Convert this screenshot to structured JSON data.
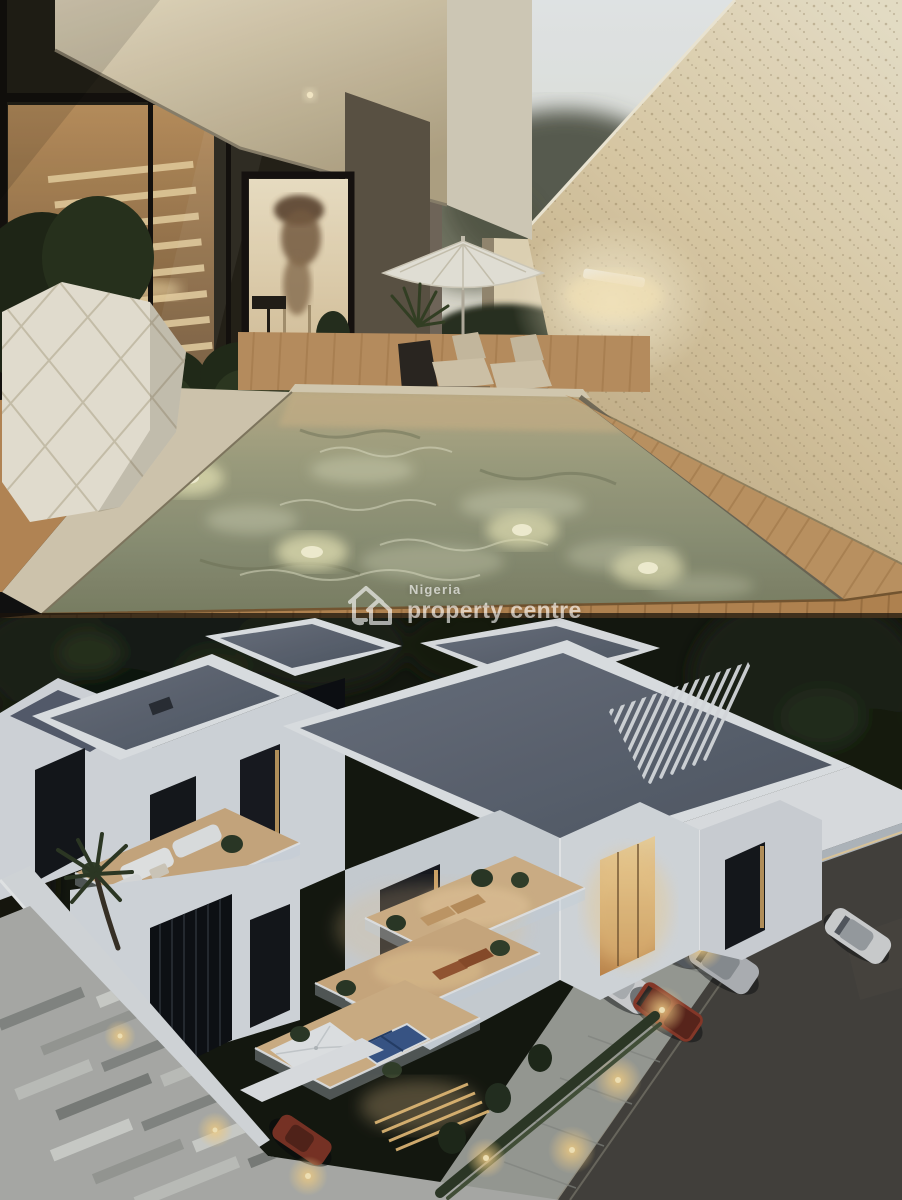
{
  "page": {
    "type": "property-listing-photo-collage",
    "photo_count": 2
  },
  "watermark": {
    "logo": "house-icon",
    "line1": "Nigeria",
    "line2": "property centre",
    "color": "#ffffff",
    "opacity": 0.62
  },
  "photos": [
    {
      "alt": "Dusk courtyard of a modern duplex: floor-to-ceiling glass with lit interior staircase, portrait wall art behind glass door, hanging plants and a white faceted planter, long lap pool with underwater lights, white patio umbrella with two sun loungers, tall speckled beige boundary wall with a glowing wall sconce, timber deck in the foreground",
      "key_elements": [
        "glass facade",
        "interior staircase",
        "portrait artwork",
        "patio umbrella",
        "sun loungers",
        "lap pool",
        "underwater lights",
        "boundary wall",
        "wall sconce",
        "hanging planters",
        "faceted vase planter",
        "timber deck"
      ]
    },
    {
      "alt": "Aerial dusk view of a white contemporary multi-storey residence: flat grey roofs with white parapets, rooftop pergola slats, warm-lit stepped balconies with plants, loungers, white umbrella and blue solar panels, rooftop lounge with white sofas, palm tree, striped paver forecourt, hedge-lined driveway with four parked cars, road with one passing car, warm bollard lights",
      "key_elements": [
        "grey flat roofs",
        "white parapets",
        "pergola slats",
        "stepped balconies",
        "glass railings",
        "solar panels",
        "rooftop lounge sofas",
        "palm tree",
        "striped pavers",
        "hedges",
        "driveway",
        "parked cars",
        "road car",
        "bollard lights"
      ],
      "parked_car_count": 4,
      "road_car_count": 1
    }
  ],
  "palette": {
    "sky": "#e9eef0",
    "boundary_wall": "#e4d4b0",
    "sconce_glow": "#fff3d0",
    "pool_water": "#979c7c",
    "deck": "#bb8c55",
    "interior_glow": "#f2dcae",
    "roof_grey": "#5d6572",
    "building_white": "#e8ebed",
    "balcony_warm": "#d9b88c",
    "window_glow": "#f7d79e",
    "trees_dark": "#151a10",
    "paver_light": "#c9cbc6",
    "paver_dark": "#84887f",
    "road": "#46443e",
    "car_red": "#8e3b2a",
    "lamp_glow": "#ffd27a"
  }
}
